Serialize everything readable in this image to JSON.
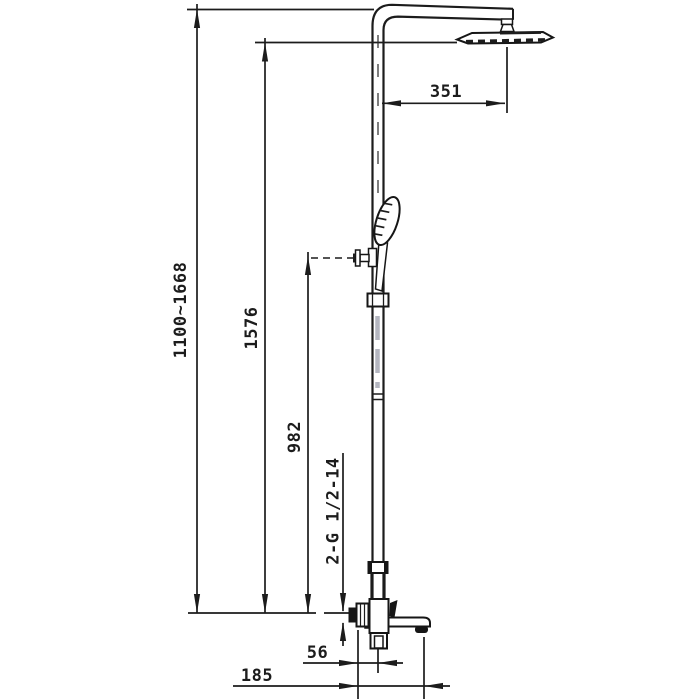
{
  "drawing": {
    "kind": "technical dimension drawing",
    "subject": "exposed thermostatic shower column with rain head, hand shower and bath spout",
    "labels": {
      "overall_height": "1100~1668",
      "head_height": "1576",
      "holder_height": "982",
      "thread_spec": "2-G 1/2-14",
      "head_reach": "351",
      "spout_center_offset": "56",
      "spout_reach": "185"
    },
    "colors": {
      "ink": "#1c1c1c",
      "background": "#ffffff"
    }
  }
}
